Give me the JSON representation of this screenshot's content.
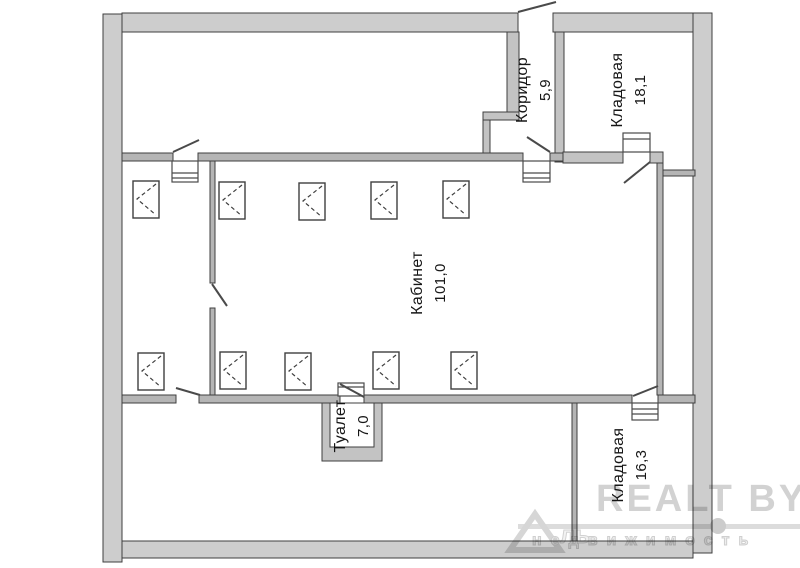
{
  "rooms": [
    {
      "name": "Коридор",
      "area": "5,9"
    },
    {
      "name": "Кладовая",
      "area": "18,1"
    },
    {
      "name": "Кабинет",
      "area": "101,0"
    },
    {
      "name": "Туалет",
      "area": "7,0"
    },
    {
      "name": "Кладовая",
      "area": "16,3"
    }
  ],
  "watermark": {
    "brand": "REALT BY",
    "subtitle": "недвижимость",
    "logo_text": "ль"
  },
  "colors": {
    "outer_wall_fill": "#cdcdcd",
    "inner_wall_fill": "#b5b5b5",
    "wall_stroke": "#3f3f3f",
    "label_text": "#161616",
    "watermark_gray": "#d2d2d2"
  }
}
